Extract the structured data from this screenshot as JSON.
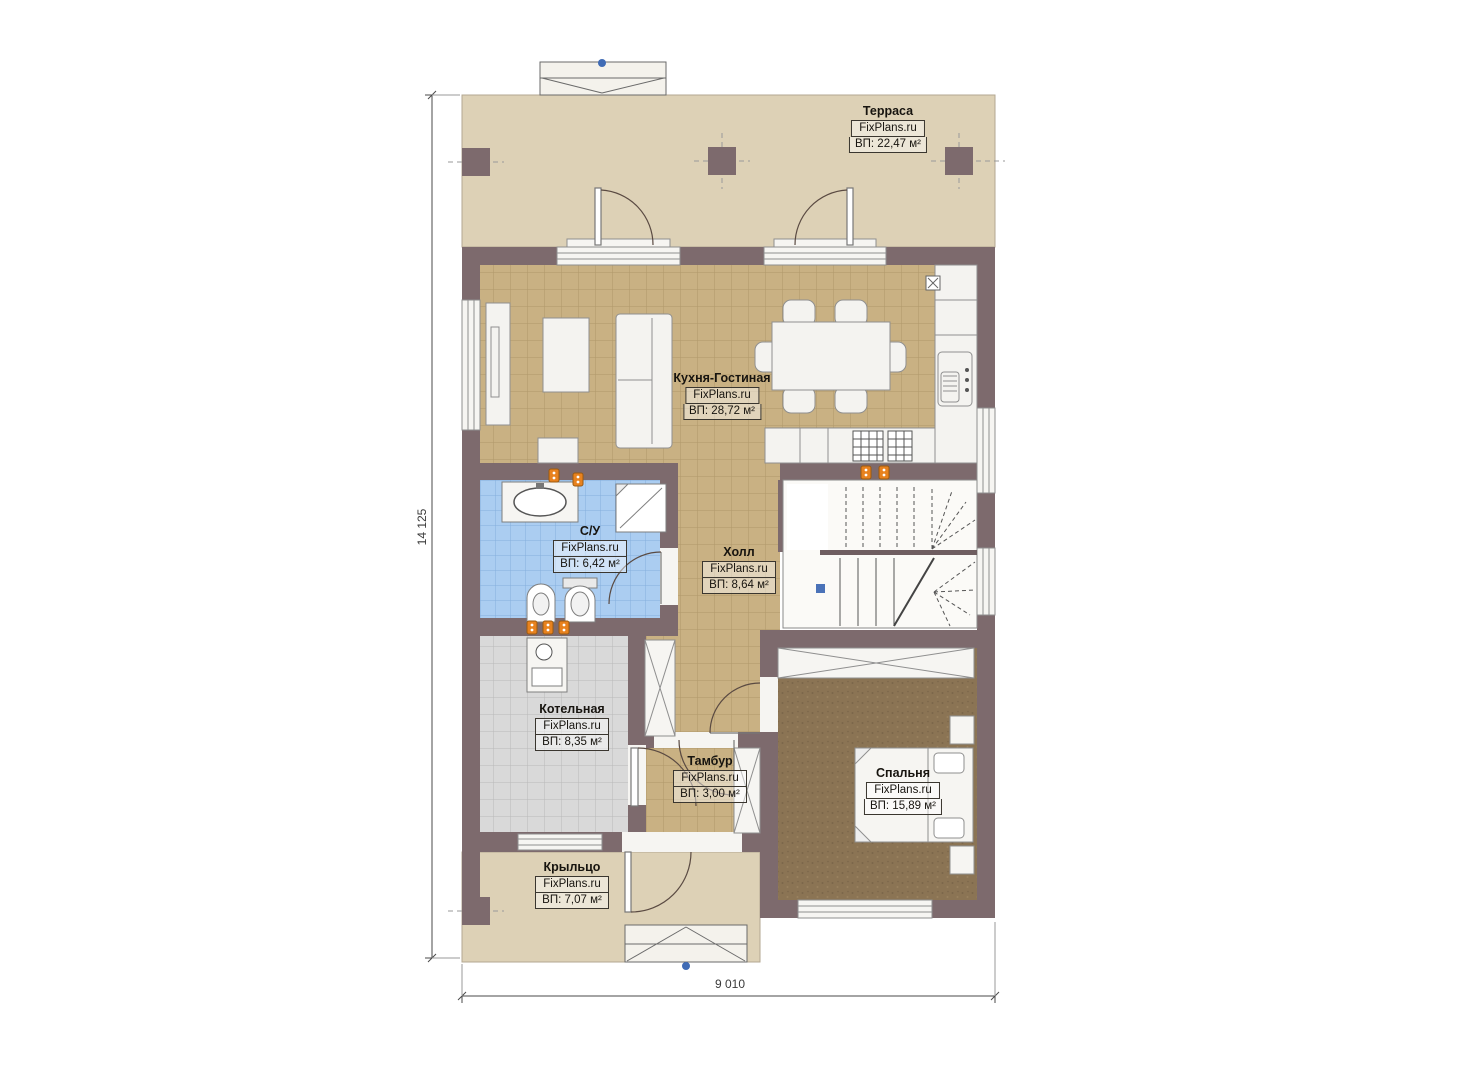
{
  "site": "FixPlans.ru",
  "rooms": [
    {
      "name": "Терраса",
      "watermark": "FixPlans.ru",
      "area": "ВП: 22,47 м²"
    },
    {
      "name": "Кухня-Гостиная",
      "watermark": "FixPlans.ru",
      "area": "ВП: 28,72 м²"
    },
    {
      "name": "С/У",
      "watermark": "FixPlans.ru",
      "area": "ВП: 6,42 м²"
    },
    {
      "name": "Холл",
      "watermark": "FixPlans.ru",
      "area": "ВП: 8,64 м²"
    },
    {
      "name": "Котельная",
      "watermark": "FixPlans.ru",
      "area": "ВП: 8,35 м²"
    },
    {
      "name": "Тамбур",
      "watermark": "FixPlans.ru",
      "area": "ВП: 3,00 м²"
    },
    {
      "name": "Спальня",
      "watermark": "FixPlans.ru",
      "area": "ВП: 15,89 м²"
    },
    {
      "name": "Крыльцо",
      "watermark": "FixPlans.ru",
      "area": "ВП: 7,07 м²"
    }
  ],
  "dimensions": {
    "height": "14 125",
    "width": "9 010"
  },
  "colors": {
    "wall": "#7d6a6d",
    "terrace_floor": "#ddd1b6",
    "kitchen_tile": "#c9b183",
    "bathroom_tile": "#abcdf1",
    "boiler_tile": "#d9d9d9",
    "bedroom_carpet": "#8b7454",
    "socket_orange": "#e8821e",
    "marker_blue": "#3f6bb5"
  }
}
